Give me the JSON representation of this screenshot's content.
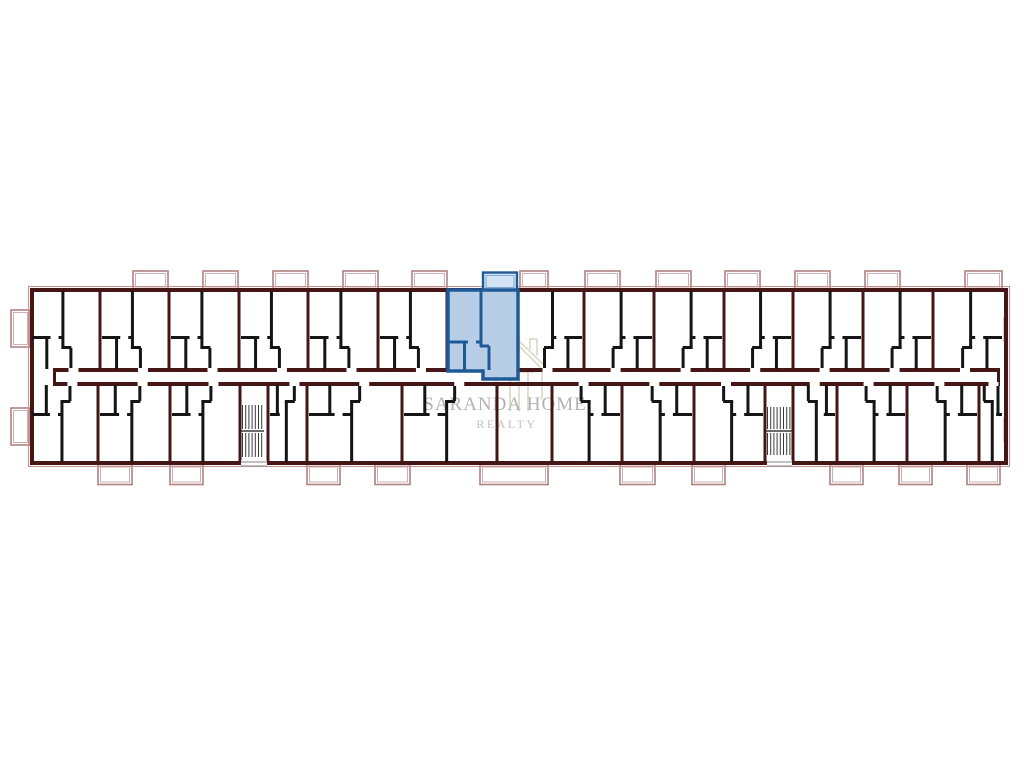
{
  "watermark": {
    "title": "SARANDA HOME",
    "subtitle": "REALTY",
    "text_color": "#b2b2b2",
    "subtitle_color": "#c0c0c0",
    "icon_color": "#dcd3bc"
  },
  "plan": {
    "colors": {
      "wall": "#451616",
      "wall_black": "#151515",
      "balcony": "#b08282",
      "balcony_light": "#cfb0b0",
      "building_outline": "#c9908f",
      "window": "#c3a075",
      "stairs": "#3a3a3a",
      "entrance": "#9a9a9a",
      "door_gap": "#ffffff"
    },
    "building": {
      "x1": 30,
      "y1": 288,
      "x2": 1008,
      "y2": 465
    },
    "corridor": {
      "x1": 56,
      "y1": 368,
      "x2": 997,
      "y2": 382
    },
    "partitions_top": [
      100,
      169,
      239,
      308,
      378,
      447,
      517,
      584,
      654,
      724,
      793,
      863,
      933
    ],
    "partitions_bottom": [
      98,
      170,
      240,
      268,
      307,
      402,
      497,
      552,
      622,
      694,
      765,
      793,
      837,
      907,
      979
    ],
    "units_top": [
      {
        "x": 30,
        "w": 70,
        "m": 0
      },
      {
        "x": 100,
        "w": 69,
        "m": 0
      },
      {
        "x": 169,
        "w": 70,
        "m": 0
      },
      {
        "x": 239,
        "w": 69,
        "m": 0
      },
      {
        "x": 308,
        "w": 70,
        "m": 0
      },
      {
        "x": 378,
        "w": 69,
        "m": 0
      },
      {
        "x": 517,
        "w": 67,
        "m": 1
      },
      {
        "x": 584,
        "w": 70,
        "m": 1
      },
      {
        "x": 654,
        "w": 70,
        "m": 1
      },
      {
        "x": 724,
        "w": 69,
        "m": 1
      },
      {
        "x": 793,
        "w": 70,
        "m": 1
      },
      {
        "x": 863,
        "w": 70,
        "m": 1
      },
      {
        "x": 933,
        "w": 71,
        "m": 1
      }
    ],
    "units_bottom": [
      {
        "x": 30,
        "w": 68,
        "m": 0
      },
      {
        "x": 98,
        "w": 72,
        "m": 0
      },
      {
        "x": 170,
        "w": 70,
        "m": 0
      },
      {
        "x": 268,
        "w": 39,
        "m": 0
      },
      {
        "x": 307,
        "w": 95,
        "m": 0
      },
      {
        "x": 402,
        "w": 95,
        "m": 0
      },
      {
        "x": 552,
        "w": 70,
        "m": 1
      },
      {
        "x": 622,
        "w": 72,
        "m": 1
      },
      {
        "x": 694,
        "w": 71,
        "m": 1
      },
      {
        "x": 793,
        "w": 44,
        "m": 1
      },
      {
        "x": 837,
        "w": 70,
        "m": 1
      },
      {
        "x": 907,
        "w": 72,
        "m": 1
      },
      {
        "x": 979,
        "w": 25,
        "m": 1
      }
    ],
    "balconies_top": [
      {
        "x": 133,
        "w": 35
      },
      {
        "x": 203,
        "w": 35
      },
      {
        "x": 273,
        "w": 35
      },
      {
        "x": 343,
        "w": 35
      },
      {
        "x": 412,
        "w": 35
      },
      {
        "x": 520,
        "w": 28
      },
      {
        "x": 585,
        "w": 35
      },
      {
        "x": 656,
        "w": 35
      },
      {
        "x": 725,
        "w": 35
      },
      {
        "x": 795,
        "w": 35
      },
      {
        "x": 865,
        "w": 35
      },
      {
        "x": 965,
        "w": 37
      }
    ],
    "balconies_bottom": [
      {
        "x": 98,
        "w": 34
      },
      {
        "x": 170,
        "w": 33
      },
      {
        "x": 307,
        "w": 33
      },
      {
        "x": 375,
        "w": 35
      },
      {
        "x": 480,
        "w": 68
      },
      {
        "x": 620,
        "w": 35
      },
      {
        "x": 692,
        "w": 33
      },
      {
        "x": 830,
        "w": 33
      },
      {
        "x": 899,
        "w": 33
      },
      {
        "x": 967,
        "w": 33
      }
    ],
    "balconies_left": [
      {
        "y": 310,
        "h": 37
      },
      {
        "y": 408,
        "h": 37
      }
    ],
    "windows_right": [
      {
        "y": 317,
        "h": 25
      },
      {
        "y": 417,
        "h": 25
      }
    ],
    "stairwells": [
      {
        "x": 241,
        "y": 404,
        "w": 23,
        "h": 54
      },
      {
        "x": 766,
        "y": 406,
        "w": 26,
        "h": 50
      }
    ],
    "entrances": [
      {
        "x": 241,
        "w": 26
      },
      {
        "x": 767,
        "w": 25
      }
    ],
    "highlight": {
      "fill": "#b8cee7",
      "stroke": "#1e5a97",
      "stroke_light": "#7fa9d3",
      "balcony_fill": "#d4e3f3",
      "balcony": {
        "x": 483,
        "y": 272.5,
        "w": 34,
        "h": 18
      },
      "outline": "448,290 518,290 518,379 483,379 483,371 448,371",
      "inner_walls": [
        [
          481,
          291,
          481,
          347
        ],
        [
          480,
          346,
          489,
          346
        ],
        [
          489,
          346,
          489,
          370
        ],
        [
          449,
          342,
          468,
          342
        ],
        [
          476,
          342,
          481,
          342
        ],
        [
          464.5,
          343,
          464.5,
          370
        ]
      ]
    }
  }
}
